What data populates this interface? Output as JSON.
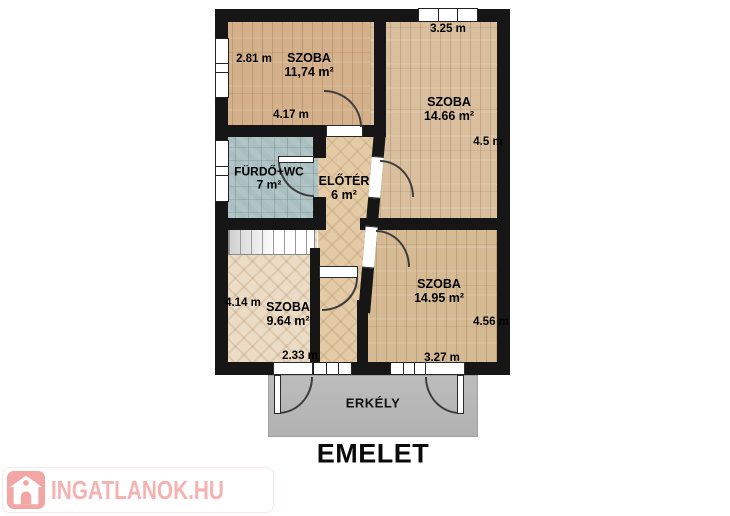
{
  "plan": {
    "floor_title": "EMELET",
    "balcony_label": "ERKÉLY",
    "rooms": {
      "room_top_left": {
        "name": "SZOBA",
        "area": "11,74 m²"
      },
      "room_top_right": {
        "name": "SZOBA",
        "area": "14.66 m²"
      },
      "bathroom": {
        "name": "FÜRDŐ+WC",
        "area": "7 m²"
      },
      "hallway": {
        "name": "ELŐTÉR",
        "area": "6 m²"
      },
      "room_bottom_right": {
        "name": "SZOBA",
        "area": "14.95 m²"
      },
      "room_bottom_left": {
        "name": "SZOBA",
        "area": "9.64 m²"
      }
    },
    "dimensions": {
      "room_top_left_height": "2.81 m",
      "room_top_left_width": "4.17 m",
      "room_top_right_width": "3.25 m",
      "room_top_right_height": "4.5 m",
      "room_bottom_left_height": "4.14 m",
      "room_bottom_left_width": "2.33 m",
      "room_bottom_right_width": "3.27 m",
      "room_bottom_right_height": "4.56 m"
    }
  },
  "watermark": {
    "brand": "INGATLANOK.HU"
  },
  "colors": {
    "wall": "#161616",
    "plank_floor_1": "#d4b18a",
    "plank_floor_2": "#dabf9e",
    "plank_floor_3": "#d6ba94",
    "bath_tile": "#a9bfc0",
    "herringbone_room": "#ecdcc5",
    "herringbone_hall": "#e4cba6",
    "balcony_gray": "#b7b7b7",
    "brand_pink": "#f2a7a5"
  }
}
